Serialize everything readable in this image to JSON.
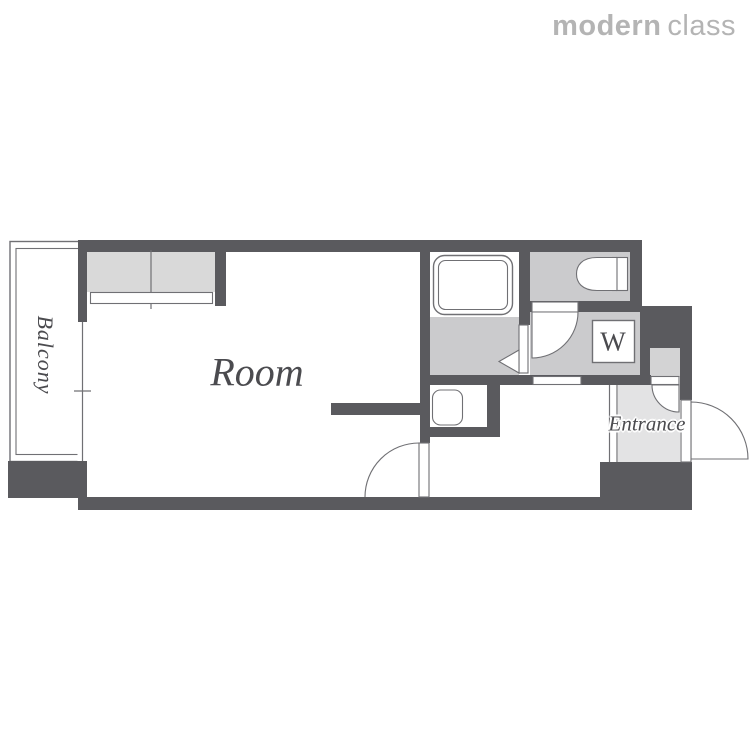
{
  "logo": {
    "brand_bold": "modern",
    "brand_light": "class",
    "color": "#b4b4b4"
  },
  "floorplan": {
    "labels": {
      "room": "Room",
      "balcony": "Balcony",
      "entrance": "Entrance",
      "washer": "W"
    },
    "colors": {
      "wall": "#5a5a5e",
      "floor_gray": "#cbcbcd",
      "closet_gray": "#d9d9d9",
      "entrance_gray": "#e3e3e4",
      "shoe_cabinet_gray": "#d3d3d4",
      "label_text": "#4b4b4f",
      "outline": "#707074",
      "logo_color": "#b4b4b4"
    }
  }
}
